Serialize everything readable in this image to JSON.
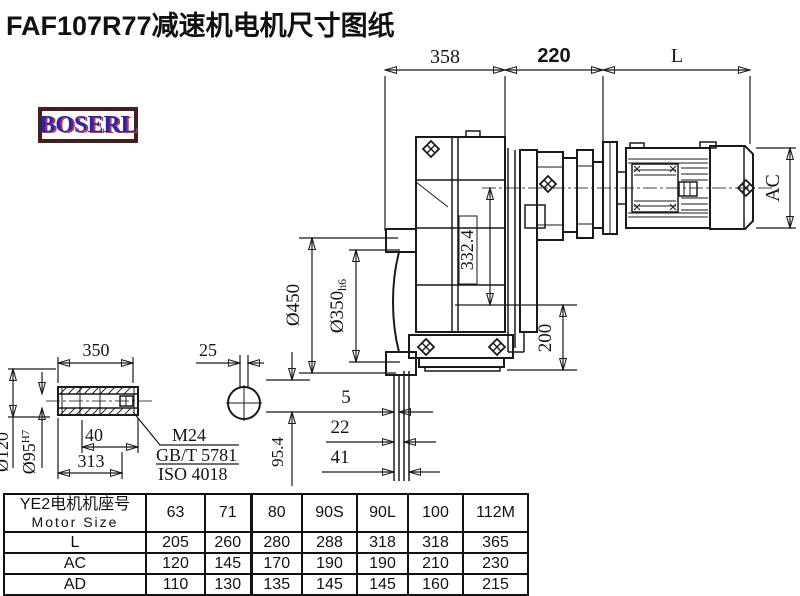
{
  "title": "FAF107R77减速机电机尺寸图纸",
  "logo": {
    "text": "BOSERL"
  },
  "dims": {
    "top_358": "358",
    "top_220": "220",
    "top_L": "L",
    "ac": "AC",
    "dia450": "Ø450",
    "dia350": "Ø350",
    "dia350_tol": "h6",
    "v332": "332.4",
    "v200": "200",
    "gap5": "5",
    "gap22": "22",
    "gap41": "41",
    "v954": "95.4"
  },
  "shaft_detail": {
    "len350": "350",
    "dia120": "Ø120",
    "dia95": "Ø95",
    "dia95_tol": "H7",
    "len40": "40",
    "len313": "313",
    "key25": "25",
    "note_m24": "M24",
    "note_gbt": "GB/T 5781",
    "note_iso": "ISO 4018"
  },
  "table": {
    "header_cn": "YE2电机机座号",
    "header_en": "Motor Size",
    "columns": [
      "63",
      "71",
      "80",
      "90S",
      "90L",
      "100",
      "112M"
    ],
    "rows": [
      {
        "label": "L",
        "values": [
          "205",
          "260",
          "280",
          "288",
          "318",
          "318",
          "365"
        ]
      },
      {
        "label": "AC",
        "values": [
          "120",
          "145",
          "170",
          "190",
          "190",
          "210",
          "230"
        ]
      },
      {
        "label": "AD",
        "values": [
          "110",
          "130",
          "135",
          "145",
          "145",
          "160",
          "215"
        ]
      }
    ]
  },
  "colors": {
    "line": "#1a1a1a",
    "logo_border": "#40211f",
    "logo_text": "#2424c0",
    "logo_shadow": "#c23a2e"
  }
}
